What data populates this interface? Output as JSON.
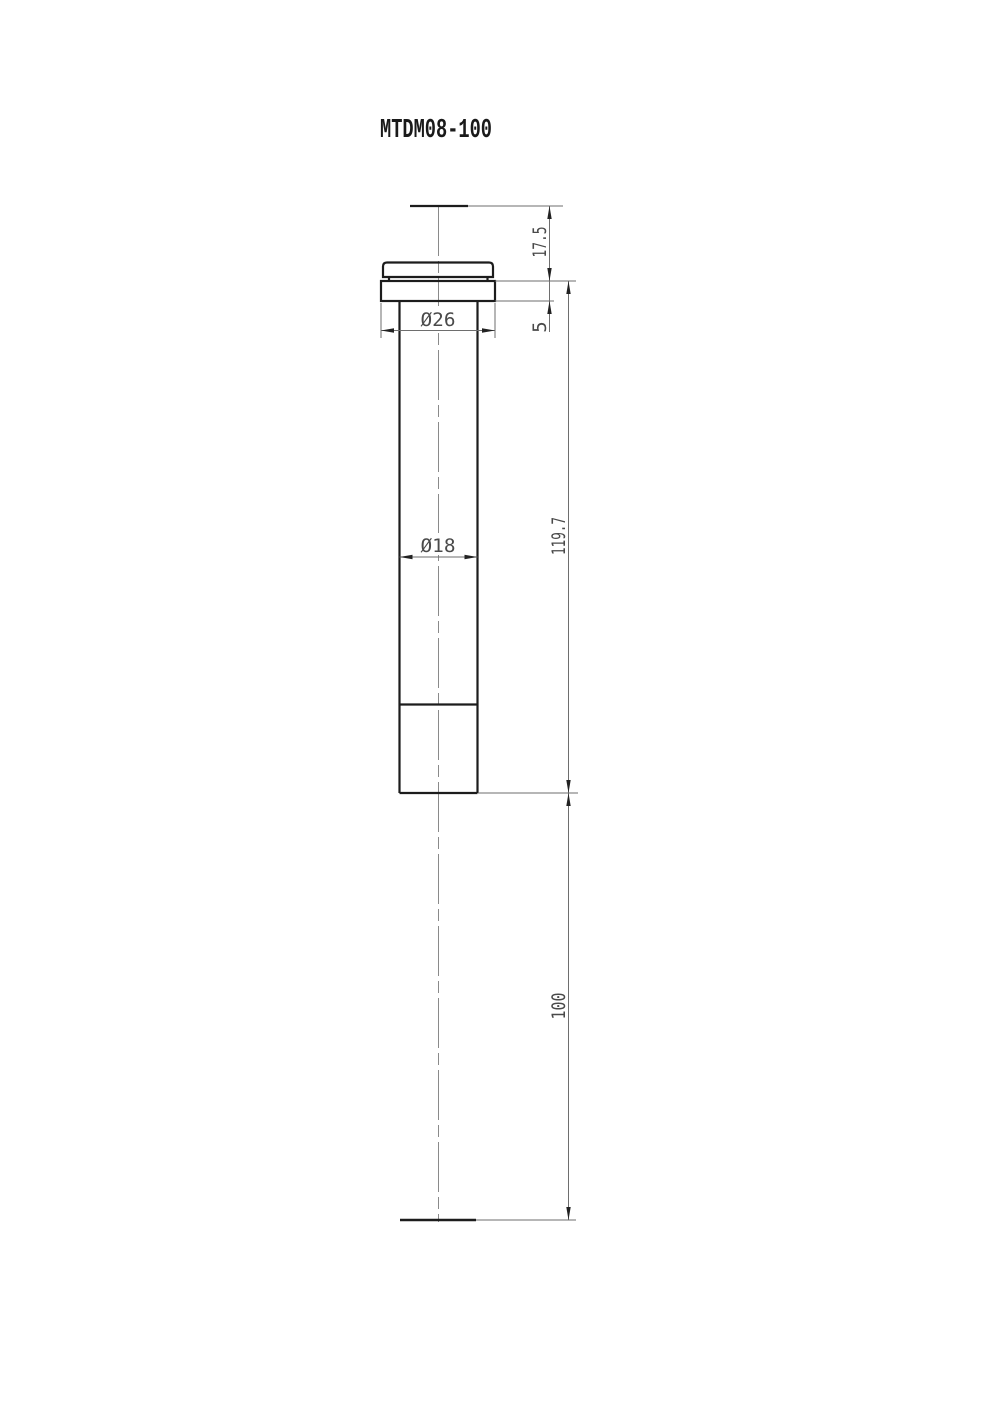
{
  "title": "MTDM08-100",
  "drawing": {
    "type": "engineering-drawing",
    "view": "front-view-of-cylindrical-damper",
    "line_color_bold": "#1c1c1c",
    "line_color_thin": "#6e6e6e",
    "background": "#ffffff"
  },
  "dimensions": {
    "head_height": "17.5",
    "flange_thickness": "5",
    "flange_diameter": "Ø26",
    "body_diameter": "Ø18",
    "body_length": "119.7",
    "stroke_length": "100"
  }
}
